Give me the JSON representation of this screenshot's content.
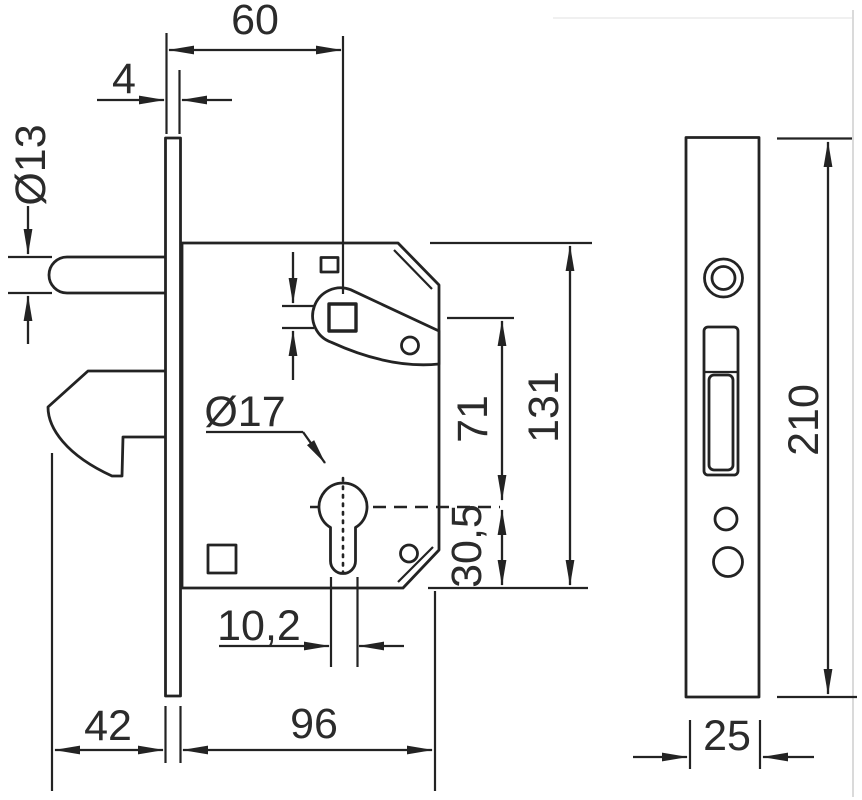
{
  "colors": {
    "background": "#ffffff",
    "line": "#232323",
    "text": "#2b2b2b",
    "scan_border": "#dadada"
  },
  "dimensions": {
    "backset": "60",
    "faceplate_thickness": "4",
    "pin_diameter": "Ø13",
    "cylinder_hole_diameter": "Ø17",
    "case_height": "131",
    "follower_to_cylinder": "71",
    "cylinder_to_case_bottom": "30,5",
    "cylinder_stem_width": "10,2",
    "hook_projection": "42",
    "case_depth": "96",
    "faceplate_height": "210",
    "faceplate_width": "25"
  }
}
